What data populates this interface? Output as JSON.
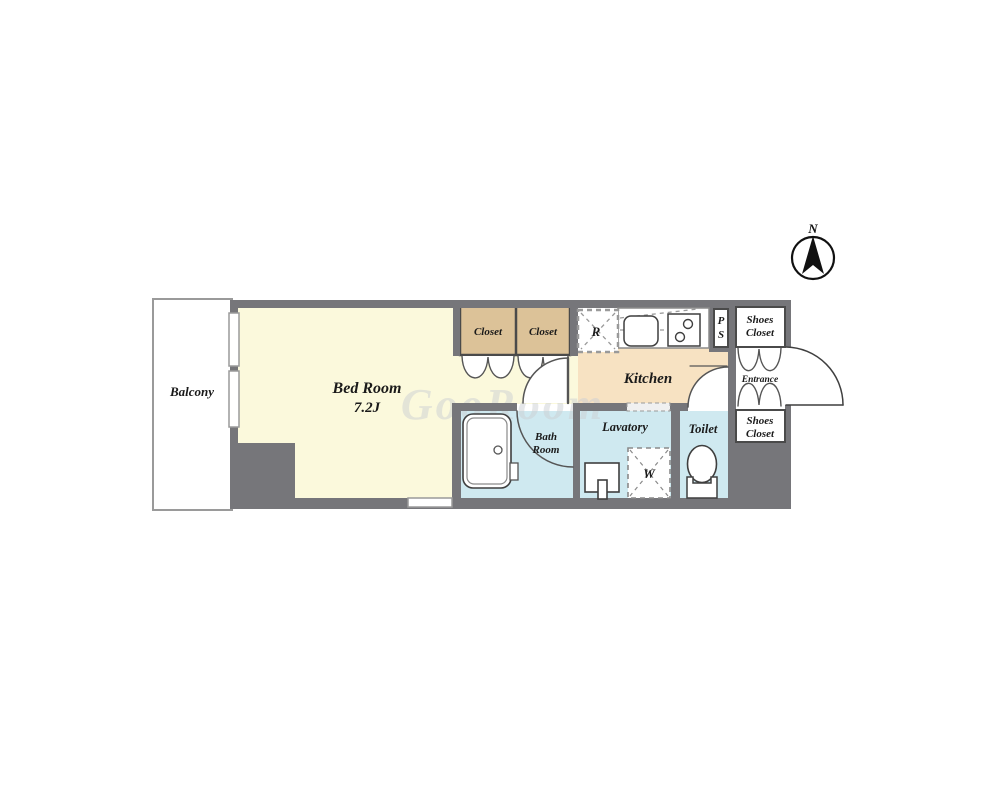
{
  "plan": {
    "rooms": {
      "balcony": {
        "label": "Balcony"
      },
      "bedroom": {
        "label": "Bed Room",
        "size_label": "7.2J"
      },
      "closet_left": {
        "label": "Closet"
      },
      "closet_right": {
        "label": "Closet"
      },
      "kitchen": {
        "label": "Kitchen"
      },
      "refrigerator_space": {
        "label": "R"
      },
      "pipe_shaft": {
        "line1": "P",
        "line2": "S"
      },
      "shoes_closet_top": {
        "line1": "Shoes",
        "line2": "Closet"
      },
      "entrance": {
        "label": "Entrance"
      },
      "shoes_closet_bottom": {
        "line1": "Shoes",
        "line2": "Closet"
      },
      "bath": {
        "line1": "Bath",
        "line2": "Room"
      },
      "lavatory": {
        "label": "Lavatory"
      },
      "toilet": {
        "label": "Toilet"
      },
      "washer_space": {
        "label": "W"
      }
    },
    "compass": {
      "label": "N"
    },
    "watermark": "GooRoom"
  },
  "colors": {
    "wall": "#76767a",
    "bedroom": "#fbf9dc",
    "closet": "#dcc298",
    "kitchen": "#f7e2c2",
    "water": "#cfe9f0",
    "white": "#ffffff",
    "outline": "#3f3f3f",
    "door_line": "#555555",
    "balcony_border": "#9a9a9a",
    "watermark": "#cdd0d4",
    "text": "#1a1a1a"
  }
}
